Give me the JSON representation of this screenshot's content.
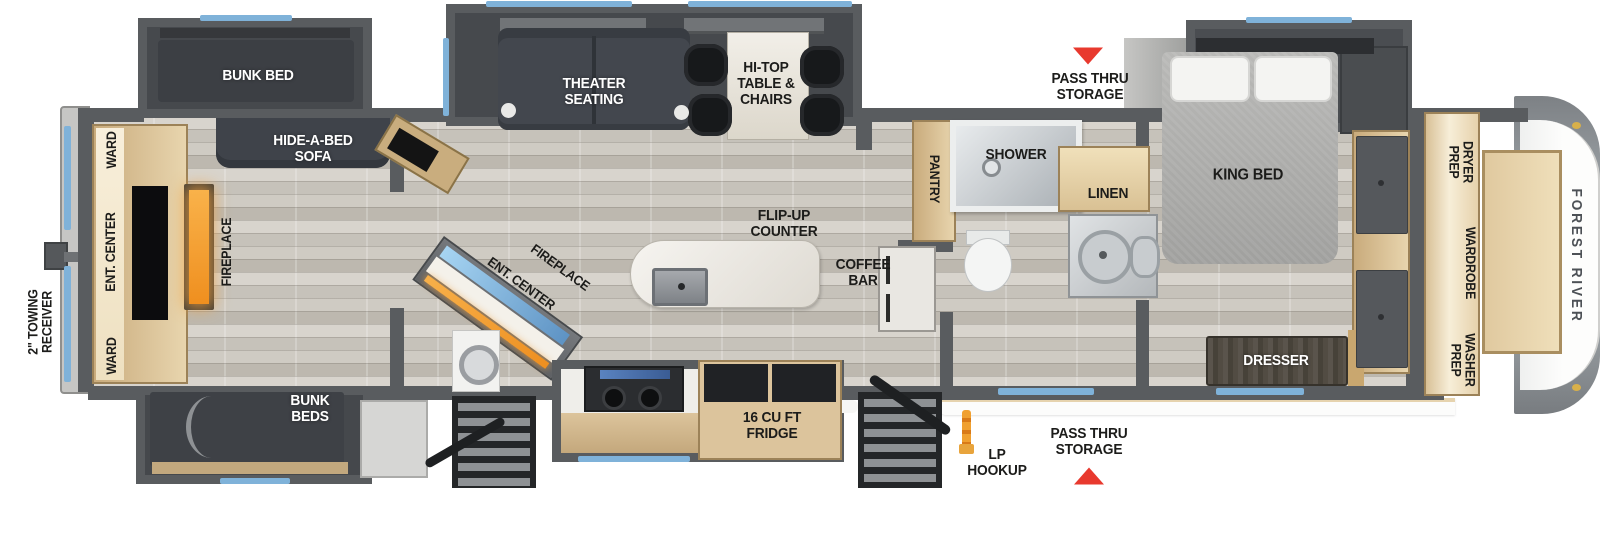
{
  "colors": {
    "wall": "#595c5f",
    "window_blue": "#7fb2d9",
    "arrow_red": "#e8392e",
    "fireplace_orange": "#f29b2f",
    "lp_orange": "#e0851f",
    "cabinet_tan": "#dcc49c"
  },
  "labels": {
    "towing": "2\" TOWING\nRECEIVER",
    "ward_top": "WARD",
    "ent_center_rear": "ENT. CENTER",
    "ward_bottom": "WARD",
    "fireplace_rear": "FIREPLACE",
    "bunk_bed": "BUNK BED",
    "hide_a_bed": "HIDE-A-BED\nSOFA",
    "bunk_beds": "BUNK\nBEDS",
    "theater": "THEATER\nSEATING",
    "hi_top": "HI-TOP\nTABLE &\nCHAIRS",
    "fireplace_mid": "FIREPLACE",
    "ent_center_mid": "ENT. CENTER",
    "flip_up": "FLIP-UP\nCOUNTER",
    "coffee_bar": "COFFEE\nBAR",
    "pantry": "PANTRY",
    "shower": "SHOWER",
    "linen": "LINEN",
    "pass_thru_top": "PASS THRU\nSTORAGE",
    "king_bed": "KING BED",
    "dresser": "DRESSER",
    "fridge": "16 CU FT\nFRIDGE",
    "lp_hookup": "LP\nHOOKUP",
    "pass_thru_bottom": "PASS THRU\nSTORAGE",
    "dryer_prep": "DRYER\nPREP",
    "wardrobe": "WARDROBE",
    "washer_prep": "WASHER\nPREP",
    "brand": "FOREST RIVER"
  }
}
